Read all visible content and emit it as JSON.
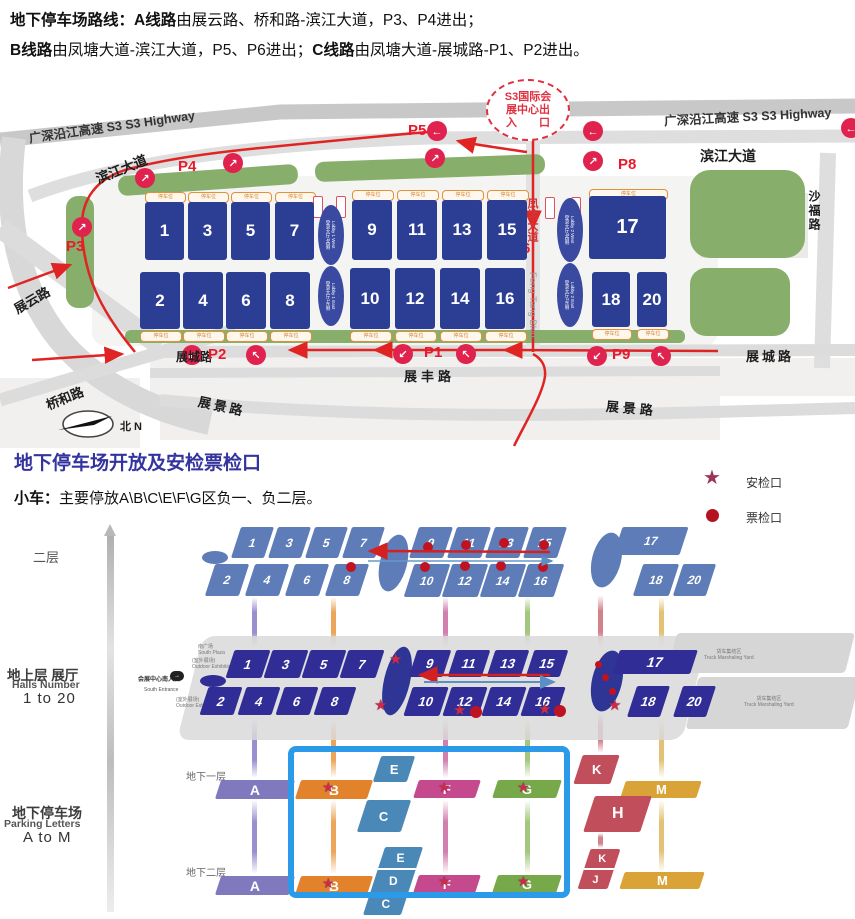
{
  "header": {
    "l1b1": "地下停车场路线：",
    "l1b2": "A线路",
    "l1r": "由展云路、桥和路-滨江大道，P3、P4进出；",
    "l2b1": "B线路",
    "l2r1": "由凤塘大道-滨江大道，P5、P6进出；",
    "l2b2": "C线路",
    "l2r2": "由凤塘大道-展城路-P1、P2进出。"
  },
  "topmap": {
    "roads": {
      "s3_left": "广深沿江高速 S3  S3 Highway",
      "s3_right": "广深沿江高速 S3  S3 Highway",
      "binjiang_left": "滨江大道",
      "binjiang_right": "滨江大道",
      "shafu": "沙福路",
      "zhanyun": "展云路",
      "qiaohe": "桥和路",
      "zhancheng_left": "展城路",
      "zhancheng_right": "展城路",
      "zhanfeng": "展丰路",
      "zhanjing_left": "展景路",
      "zhanjing_right": "展景路",
      "fengtang_cn": "凤塘大道",
      "fengtang_en": "Feng Tang Blvd"
    },
    "p": {
      "p1": "P1",
      "p2": "P2",
      "p3": "P3",
      "p4": "P4",
      "p5": "P5",
      "p6": "P6",
      "p8": "P8",
      "p9": "P9"
    },
    "s3gate": {
      "l1": "S3国际会",
      "l2": "展中心出",
      "l3": "入　　口"
    },
    "compass": "北 N",
    "strip": "停车位",
    "arrows": {
      "ne": "↗",
      "nw": "↖",
      "sw": "↙",
      "w": "←"
    },
    "lobby": {
      "l1w": "登录大厅1西侧",
      "l1w_en": "Lobby 1 West",
      "l1e": "登录大厅1东侧",
      "l1e_en": "Lobby 1 East",
      "l2w": "登录大厅2西侧",
      "l2w_en": "Lobby 2 West",
      "l2e": "登录大厅2东侧",
      "l2e_en": "Lobby 2 East"
    }
  },
  "halls": {
    "h1": "1",
    "h2": "2",
    "h3": "3",
    "h4": "4",
    "h5": "5",
    "h6": "6",
    "h7": "7",
    "h8": "8",
    "h9": "9",
    "h10": "10",
    "h11": "11",
    "h12": "12",
    "h13": "13",
    "h14": "14",
    "h15": "15",
    "h16": "16",
    "h17": "17",
    "h18": "18",
    "h19": "19",
    "h20": "20"
  },
  "section": {
    "title": "地下停车场开放及安检票检口",
    "car_bold": "小车：",
    "car_rest": "主要停放A\\B\\C\\E\\F\\G区负一、负二层。",
    "legend_star": "安检口",
    "legend_dot": "票检口"
  },
  "levels": {
    "floor2": "二层",
    "ground_cn": "地上层 展厅",
    "ground_en": "Halls Number",
    "ground_range": "1 to 20",
    "park_cn": "地下停车场",
    "park_en": "Parking Letters",
    "park_range": "A to M",
    "b1": "地下一层",
    "b2": "地下二层"
  },
  "ground": {
    "truck_cn": "货车集结区",
    "truck_en": "Truck Marshaling Yard",
    "south_plaza_cn": "南广场",
    "south_plaza_en": "South Plaza",
    "outdoor_cn": "(室外展场)",
    "outdoor_en": "Outdoor Exhibition",
    "entrance_cn": "会展中心南入口",
    "entrance_en": "South Entrance"
  },
  "parking": {
    "A": "A",
    "B": "B",
    "C": "C",
    "D": "D",
    "E": "E",
    "F": "F",
    "G": "G",
    "H": "H",
    "J": "J",
    "K": "K",
    "M": "M"
  },
  "icons": {
    "star": "★",
    "entrance_arrow": "→"
  },
  "colors": {
    "hall_blue": "#2c3e94",
    "ground_navy": "#302e96",
    "floor2_slate": "#5e7cb8",
    "route_red": "#e02424",
    "marker_pink": "#e0234e",
    "star_red": "#cf2b44",
    "legend_star": "#9c3655",
    "dot_red": "#b5121f",
    "park_A": "#8079bd",
    "park_B": "#e2832c",
    "park_CDE": "#4a88b8",
    "park_F": "#c5498d",
    "park_G": "#77a849",
    "park_HJK": "#c14f5b",
    "park_M": "#d9a338",
    "box_blue": "#2b9ae8",
    "title_blue": "#34349e"
  }
}
